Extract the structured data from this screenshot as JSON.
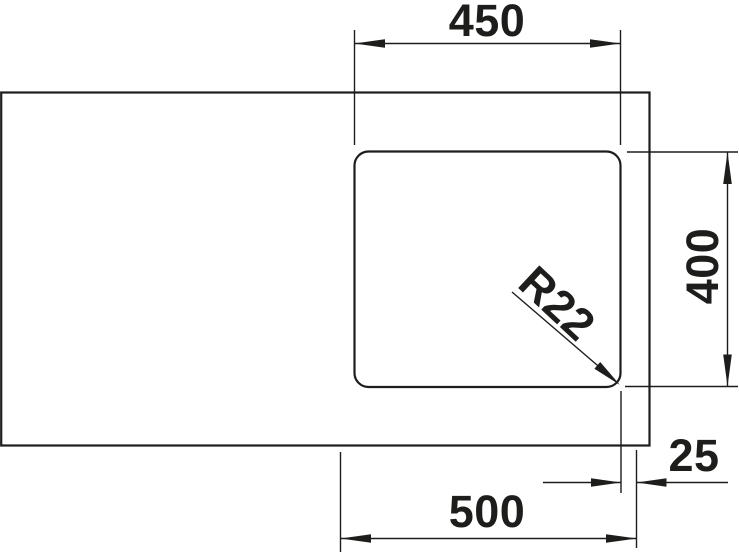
{
  "colors": {
    "line": "#1d1d1b",
    "background": "#ffffff"
  },
  "labels": {
    "bowl_width": "450",
    "bowl_depth": "400",
    "outer_width": "500",
    "edge_offset": "25",
    "corner_radius": "R22"
  }
}
